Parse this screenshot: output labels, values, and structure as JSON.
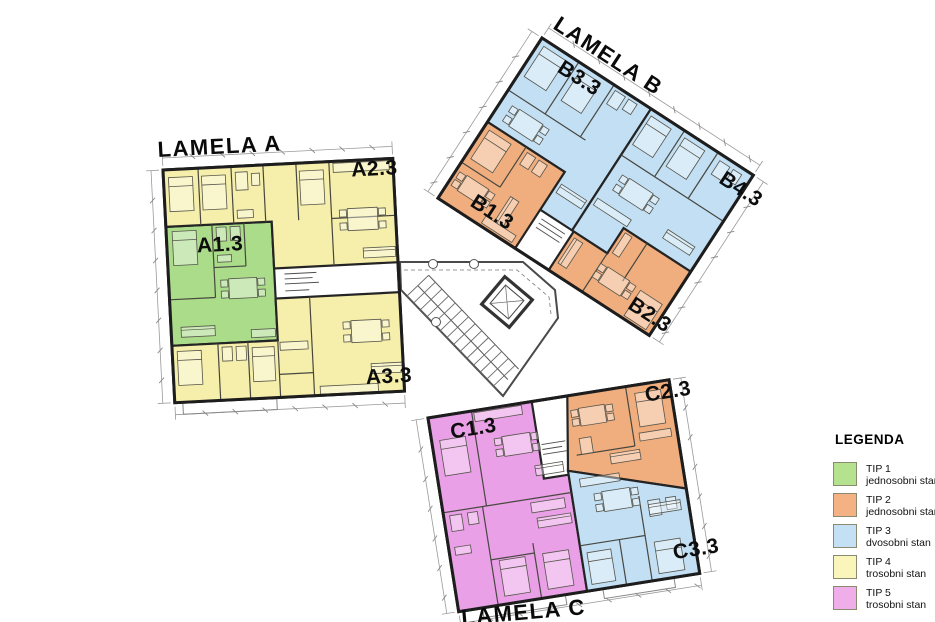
{
  "plan": {
    "buildings": [
      {
        "id": "lamela-a",
        "title": "LAMELA A",
        "units": [
          {
            "id": "A1.3",
            "type": "TIP 1"
          },
          {
            "id": "A2.3",
            "type": "TIP 4"
          },
          {
            "id": "A3.3",
            "type": "TIP 4"
          }
        ]
      },
      {
        "id": "lamela-b",
        "title": "LAMELA B",
        "units": [
          {
            "id": "B3.3",
            "type": "TIP 3"
          },
          {
            "id": "B4.3",
            "type": "TIP 3"
          },
          {
            "id": "B1.3",
            "type": "TIP 2"
          },
          {
            "id": "B2.3",
            "type": "TIP 2"
          }
        ]
      },
      {
        "id": "lamela-c",
        "title": "LAMELA C",
        "units": [
          {
            "id": "C1.3",
            "type": "TIP 5"
          },
          {
            "id": "C2.3",
            "type": "TIP 2"
          },
          {
            "id": "C3.3",
            "type": "TIP 3"
          }
        ]
      }
    ],
    "core": {
      "description": "stairwell with elevator"
    }
  },
  "legend": {
    "title": "LEGENDA",
    "items": [
      {
        "code": "TIP 1",
        "label": "jednosobni stan",
        "color": "#b5e28e",
        "plan_color": "#abdc8a"
      },
      {
        "code": "TIP 2",
        "label": "jednosobni stan",
        "color": "#f4b184",
        "plan_color": "#f0ae7e"
      },
      {
        "code": "TIP 3",
        "label": "dvosobni stan",
        "color": "#c4e0f4",
        "plan_color": "#c2dff4"
      },
      {
        "code": "TIP 4",
        "label": "trosobni stan",
        "color": "#f9f5bb",
        "plan_color": "#f5efab"
      },
      {
        "code": "TIP 5",
        "label": "trosobni stan",
        "color": "#efaeea",
        "plan_color": "#e9a0e6"
      }
    ]
  }
}
